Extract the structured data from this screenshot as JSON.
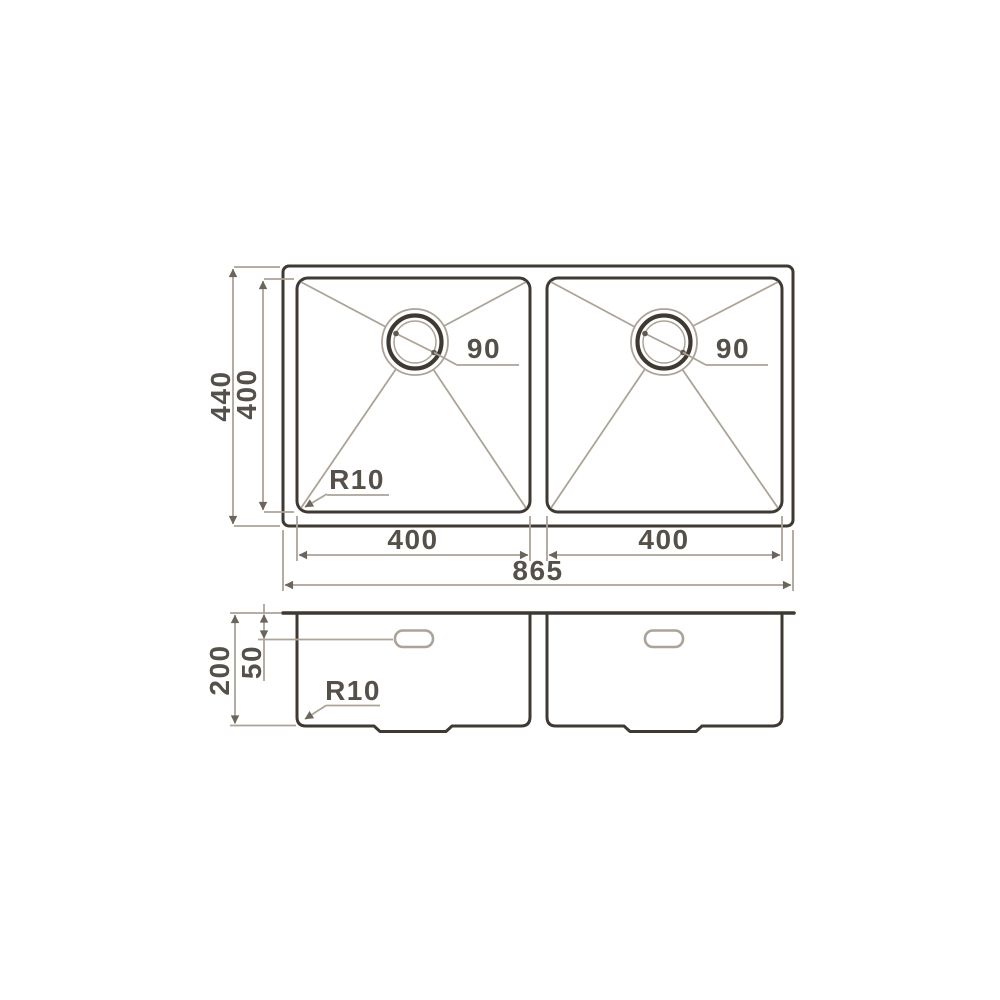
{
  "colors": {
    "background": "#ffffff",
    "line_dark": "#3e3933",
    "line_light": "#aca398",
    "dimension_text": "#55514a",
    "arrowhead": "#6b655c"
  },
  "top_view": {
    "overall_width": "865",
    "overall_depth": "440",
    "bowl_depth": "400",
    "bowl1_width": "400",
    "bowl2_width": "400",
    "drain1_diameter": "90",
    "drain2_diameter": "90",
    "corner_radius": "R10"
  },
  "side_view": {
    "bowl_height": "200",
    "overflow_offset": "50",
    "bottom_corner_radius": "R10"
  }
}
